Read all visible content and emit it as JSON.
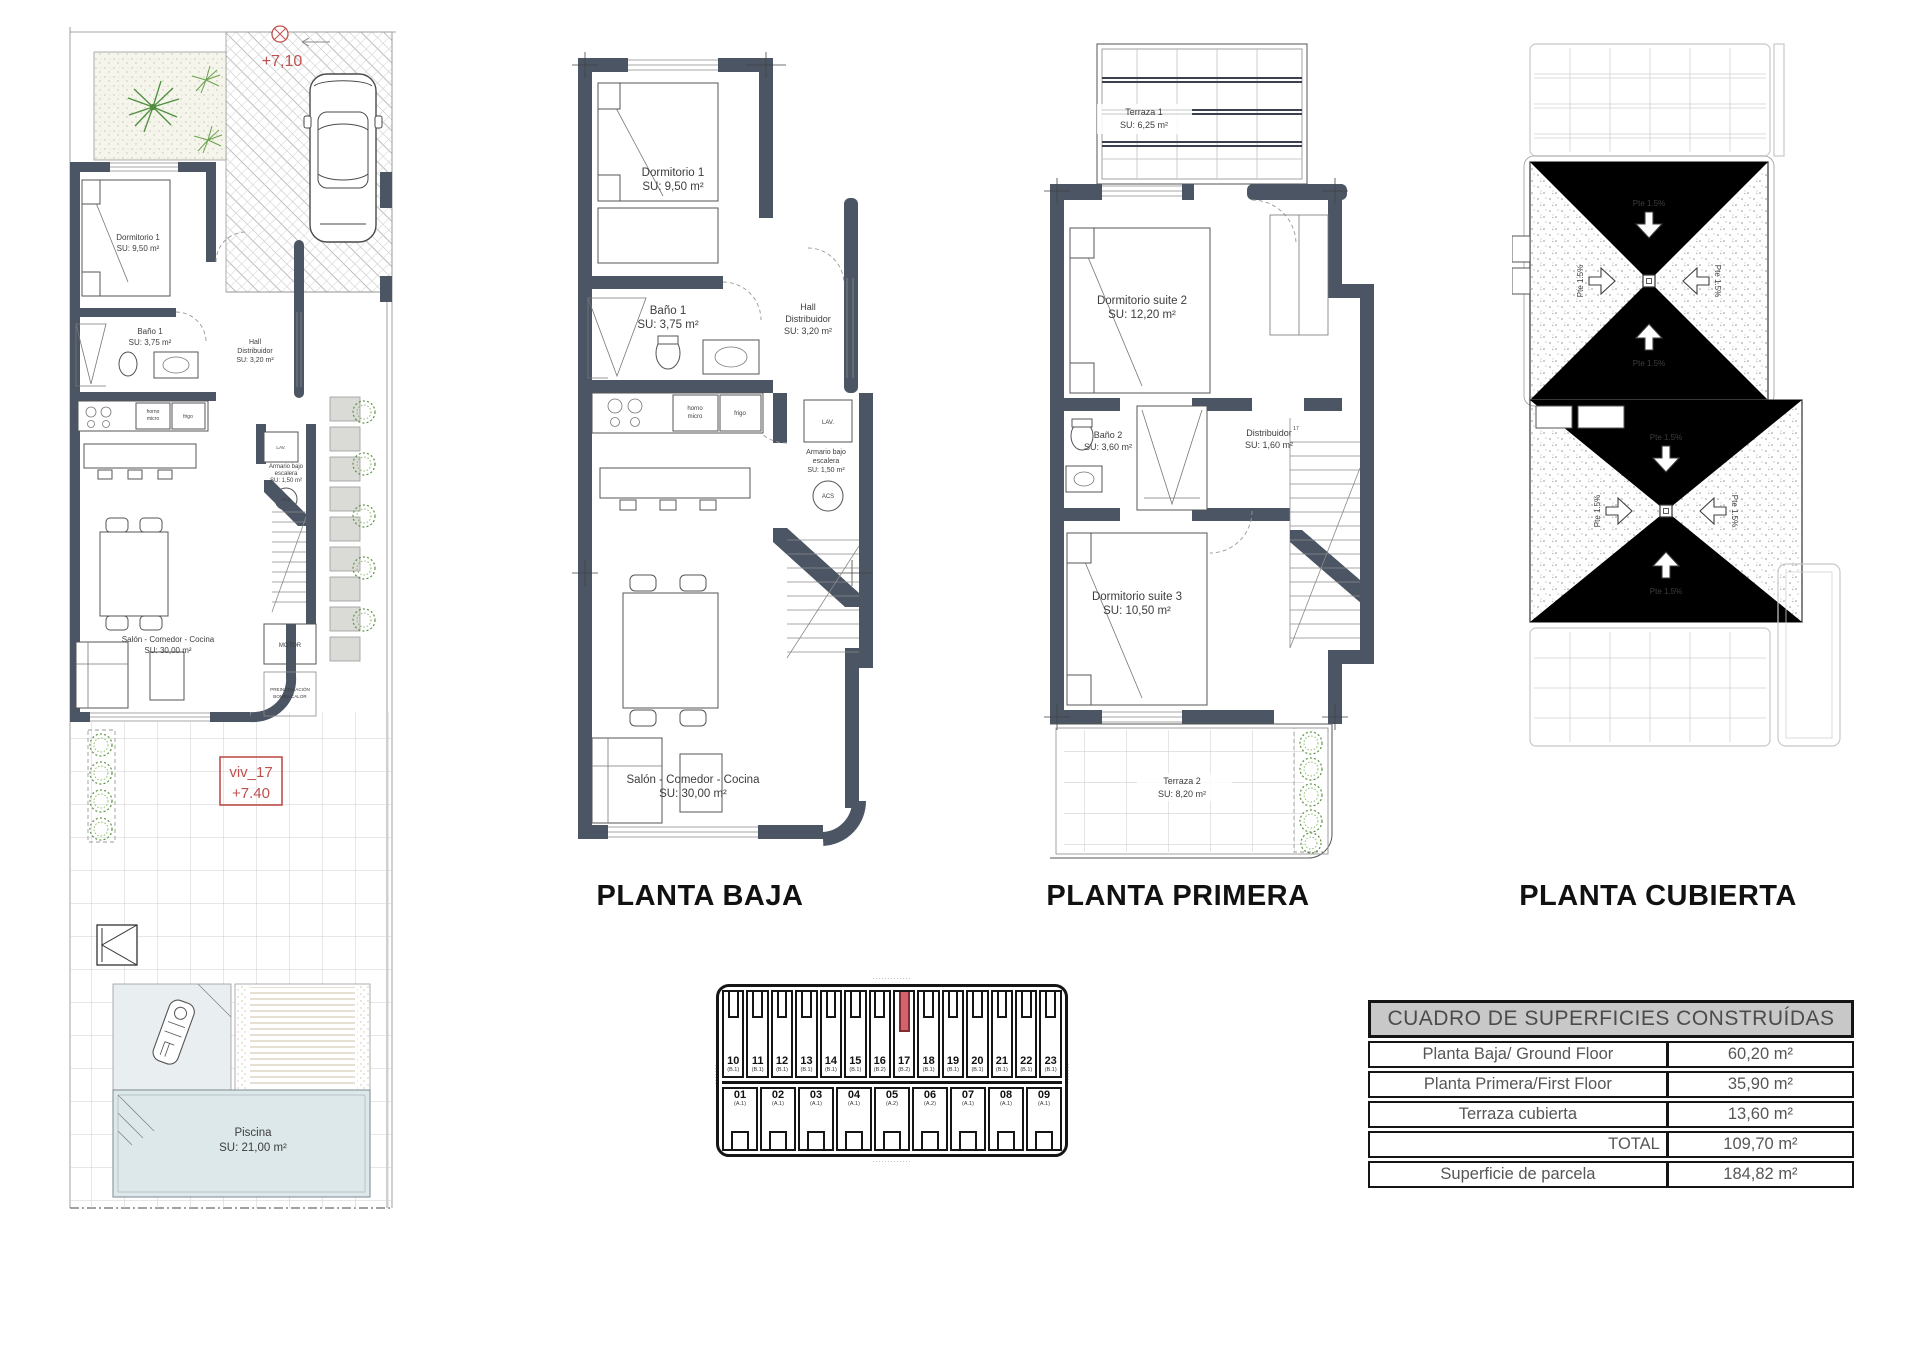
{
  "titles": {
    "baja": "PLANTA BAJA",
    "primera": "PLANTA PRIMERA",
    "cubierta": "PLANTA CUBIERTA"
  },
  "ground": {
    "dorm1": {
      "name": "Dormitorio 1",
      "area": "SU: 9,50 m²"
    },
    "bano1": {
      "name": "Baño 1",
      "area": "SU: 3,75 m²"
    },
    "hall": {
      "l1": "Hall",
      "l2": "Distribuidor",
      "area": "SU: 3,20 m²"
    },
    "armario": {
      "l1": "Armario bajo",
      "l2": "escalera",
      "area": "SU: 1,50 m²"
    },
    "salon": {
      "name": "Salón - Comedor - Cocina",
      "area": "SU: 30,00 m²"
    },
    "horno": {
      "l1": "horno",
      "l2": "micro"
    },
    "frigo": "frigo",
    "lav": "LAV.",
    "acs": "ACS"
  },
  "first": {
    "terraza1": {
      "name": "Terraza 1",
      "area": "SU: 6,25 m²"
    },
    "suite2": {
      "name": "Dormitorio suite 2",
      "area": "SU: 12,20 m²"
    },
    "bano2": {
      "name": "Baño 2",
      "area": "SU: 3,60 m²"
    },
    "distribuidor": {
      "name": "Distribuidor",
      "area": "SU: 1,60 m²"
    },
    "suite3": {
      "name": "Dormitorio suite 3",
      "area": "SU: 10,50 m²"
    },
    "terraza2": {
      "name": "Terraza 2",
      "area": "SU: 8,20 m²"
    },
    "stair_num": "17"
  },
  "roof": {
    "slope": "Pte 1.5%"
  },
  "site": {
    "level_marker": "+7,10",
    "unit_label": "viv_17",
    "unit_level": "+7.40",
    "piscina": {
      "name": "Piscina",
      "area": "SU: 21,00 m²"
    },
    "motor": "MOTOR",
    "bomba": {
      "l1": "PREINSTALACIÓN",
      "l2": "BOMBA CALOR"
    }
  },
  "key_plan": {
    "top_row": [
      {
        "num": "10",
        "type": "(B.1)"
      },
      {
        "num": "11",
        "type": "(B.1)"
      },
      {
        "num": "12",
        "type": "(B.1)"
      },
      {
        "num": "13",
        "type": "(B.1)"
      },
      {
        "num": "14",
        "type": "(B.1)"
      },
      {
        "num": "15",
        "type": "(B.1)"
      },
      {
        "num": "16",
        "type": "(B.2)"
      },
      {
        "num": "17",
        "type": "(B.2)",
        "highlight": true
      },
      {
        "num": "18",
        "type": "(B.1)"
      },
      {
        "num": "19",
        "type": "(B.1)"
      },
      {
        "num": "20",
        "type": "(B.1)"
      },
      {
        "num": "21",
        "type": "(B.1)"
      },
      {
        "num": "22",
        "type": "(B.1)"
      },
      {
        "num": "23",
        "type": "(B.1)"
      }
    ],
    "bottom_row": [
      {
        "num": "01",
        "type": "(A.1)"
      },
      {
        "num": "02",
        "type": "(A.1)"
      },
      {
        "num": "03",
        "type": "(A.1)"
      },
      {
        "num": "04",
        "type": "(A.1)"
      },
      {
        "num": "05",
        "type": "(A.2)"
      },
      {
        "num": "06",
        "type": "(A.2)"
      },
      {
        "num": "07",
        "type": "(A.1)"
      },
      {
        "num": "08",
        "type": "(A.1)"
      },
      {
        "num": "09",
        "type": "(A.1)"
      }
    ],
    "street_top": "·············",
    "street_bottom": "·············",
    "street_left": "·······",
    "street_right": "·······"
  },
  "table": {
    "title": "CUADRO DE SUPERFICIES CONSTRUÍDAS",
    "rows": [
      {
        "label": "Planta Baja/ Ground Floor",
        "value": "60,20 m²"
      },
      {
        "label": "Planta Primera/First Floor",
        "value": "35,90 m²"
      },
      {
        "label": "Terraza cubierta",
        "value": "13,60 m²"
      },
      {
        "label": "TOTAL",
        "value": "109,70 m²"
      },
      {
        "label": "Superficie de parcela",
        "value": "184,82 m²"
      }
    ]
  }
}
